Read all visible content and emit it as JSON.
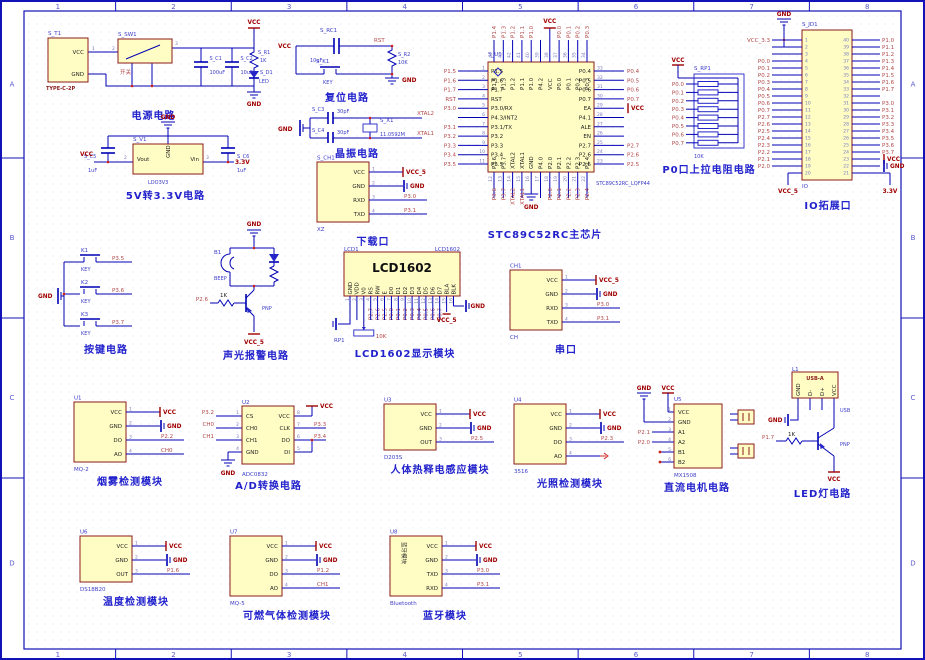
{
  "sheet": {
    "zones_h": [
      "1",
      "2",
      "3",
      "4",
      "5",
      "6",
      "7",
      "8"
    ],
    "zones_v": [
      "A",
      "B",
      "C",
      "D"
    ]
  },
  "colors": {
    "frame": "#1212b8",
    "wire": "#0000b4",
    "component_fill": "#fffdc4",
    "component_border": "#8b1a1a",
    "net_label": "#b34747",
    "power_label": "#a00000",
    "designator": "#3c3cc8",
    "caption": "#2222cc"
  },
  "modules": {
    "power": {
      "designator": "S_T1",
      "footprint": "TYPE-C-2P",
      "pin_vcc": "VCC",
      "pin_gnd": "GND",
      "num1": "1",
      "num2": "2",
      "num3": "3",
      "sw_designator": "S_SW1",
      "sw_label": "开关",
      "c1_designator": "S_C1",
      "c1_value": "100uF",
      "c2_designator": "S_C2",
      "c2_value": "10uF",
      "r1_designator": "S_R1",
      "r1_value": "1K",
      "d1_designator": "S_D1",
      "d1_value": "LED",
      "vcc": "VCC",
      "gnd": "GND",
      "caption": "电源电路"
    },
    "ldo": {
      "designator": "S_V1",
      "part": "LDO3V3",
      "pin_vout": "Vout",
      "pin_gnd": "GND",
      "pin_vin": "Vin",
      "num2": "2",
      "num3": "3",
      "c5_designator": "S_C5",
      "c5_value": "1uF",
      "c6_designator": "S_C6",
      "c6_value": "1uF",
      "vcc": "VCC",
      "out": "3.3V",
      "gnd": "GND",
      "caption": "5V转3.3V电路"
    },
    "reset": {
      "vcc": "VCC",
      "cap_designator": "S_RC1",
      "cap_value": "10uF",
      "key_designator": "S_K1",
      "key_label": "KEY",
      "rst": "RST",
      "r_designator": "S_R2",
      "r_value": "10K",
      "gnd": "GND",
      "caption": "复位电路"
    },
    "crystal": {
      "gnd": "GND",
      "c3_designator": "S_C3",
      "c3_value": "30pF",
      "c4_designator": "S_C4",
      "c4_value": "30pF",
      "x_designator": "S_X1",
      "x_value": "11.0592M",
      "net_top": "XTAL2",
      "net_bottom": "XTAL1",
      "caption": "晶振电路"
    },
    "mcu": {
      "designator": "S_U1",
      "footprint": "STC89C52RC_LQFP44",
      "vcc": "VCC",
      "gnd": "GND",
      "caption": "STC89C52RC主芯片",
      "left": [
        [
          "P1.5",
          "1",
          "P1.5"
        ],
        [
          "P1.6",
          "2",
          "P1.6"
        ],
        [
          "P1.7",
          "3",
          "P1.7"
        ],
        [
          "RST",
          "4",
          "RST"
        ],
        [
          "P3.0/RX",
          "5",
          "P3.0"
        ],
        [
          "P4.3/INT2",
          "6",
          ""
        ],
        [
          "P3.1/TX",
          "7",
          "P3.1"
        ],
        [
          "P3.2",
          "8",
          "P3.2"
        ],
        [
          "P3.3",
          "9",
          "P3.3"
        ],
        [
          "P3.4",
          "10",
          "P3.4"
        ],
        [
          "P3.5",
          "11",
          "P3.5"
        ]
      ],
      "right": [
        [
          "P0.4",
          "33",
          "P0.4"
        ],
        [
          "P0.5",
          "32",
          "P0.5"
        ],
        [
          "P0.6",
          "31",
          "P0.6"
        ],
        [
          "P0.7",
          "30",
          "P0.7"
        ],
        [
          "EA",
          "29",
          "VCC"
        ],
        [
          "P4.1",
          "28",
          ""
        ],
        [
          "ALE",
          "27",
          ""
        ],
        [
          "EN",
          "26",
          ""
        ],
        [
          "P2.7",
          "25",
          "P2.7"
        ],
        [
          "P2.6",
          "24",
          "P2.6"
        ],
        [
          "P2.5",
          "23",
          "P2.5"
        ]
      ],
      "top": [
        [
          "P1.4",
          "44",
          "P1.4"
        ],
        [
          "P1.3",
          "43",
          "P1.3"
        ],
        [
          "P1.2",
          "42",
          "P1.2"
        ],
        [
          "P1.1",
          "41",
          "P1.1"
        ],
        [
          "P1.0",
          "40",
          "P1.0"
        ],
        [
          "P4.2",
          "39",
          ""
        ],
        [
          "VCC",
          "38",
          "VCC"
        ],
        [
          "P0.0",
          "37",
          "P0.0"
        ],
        [
          "P0.1",
          "36",
          "P0.1"
        ],
        [
          "P0.2",
          "35",
          "P0.2"
        ],
        [
          "P0.3",
          "34",
          "P0.3"
        ]
      ],
      "bottom": [
        [
          "P3.6",
          "12",
          "P3.6"
        ],
        [
          "P3.7",
          "13",
          "P3.7"
        ],
        [
          "XTAL2",
          "14",
          "XTAL2"
        ],
        [
          "XTAL1",
          "15",
          "XTAL1"
        ],
        [
          "GND",
          "16",
          "GND"
        ],
        [
          "P4.0",
          "17",
          ""
        ],
        [
          "P2.0",
          "18",
          "P2.0"
        ],
        [
          "P2.1",
          "19",
          "P2.1"
        ],
        [
          "P2.2",
          "20",
          "P2.2"
        ],
        [
          "P2.3",
          "21",
          "P2.3"
        ],
        [
          "P2.4",
          "22",
          "P2.4"
        ]
      ]
    },
    "p0": {
      "designator": "S_RP1",
      "value": "10K",
      "vcc": "VCC",
      "nets": [
        "P0.0",
        "P0.1",
        "P0.2",
        "P0.3",
        "P0.4",
        "P0.5",
        "P0.6",
        "P0.7"
      ],
      "caption": "P0口上拉电阻电路"
    },
    "io": {
      "designator": "S_JD1",
      "part": "IO",
      "gnd": "GND",
      "vcc5": "VCC_5",
      "v33": "3.3V",
      "left_nums": [
        "1",
        "2",
        "3",
        "4",
        "5",
        "6",
        "7",
        "8",
        "9",
        "10",
        "11",
        "12",
        "13",
        "14",
        "15",
        "16",
        "17",
        "18",
        "19",
        "20"
      ],
      "right_nums": [
        "40",
        "39",
        "38",
        "37",
        "36",
        "35",
        "34",
        "33",
        "32",
        "31",
        "30",
        "29",
        "28",
        "27",
        "26",
        "25",
        "24",
        "23",
        "22",
        "21"
      ],
      "left_nets": [
        "VCC_3.3",
        "",
        "",
        "P0.0",
        "P0.1",
        "P0.2",
        "P0.3",
        "P0.4",
        "P0.5",
        "P0.6",
        "P0.7",
        "P2.7",
        "P2.6",
        "P2.5",
        "P2.4",
        "P2.3",
        "P2.2",
        "P2.1",
        "P2.0",
        ""
      ],
      "right_nets": [
        "P1.0",
        "P1.1",
        "P1.2",
        "P1.3",
        "P1.4",
        "P1.5",
        "P1.6",
        "P1.7",
        "",
        "P3.0",
        "P3.1",
        "P3.2",
        "P3.3",
        "P3.4",
        "P3.5",
        "P3.6",
        "P3.7",
        "VCC",
        "GND",
        ""
      ],
      "caption": "IO拓展口"
    },
    "download": {
      "designator": "S_CH1",
      "part": "XZ",
      "caption": "下载口",
      "pins": [
        {
          "name": "VCC",
          "num": "1",
          "t": "vcc",
          "net": "VCC_5"
        },
        {
          "name": "GND",
          "num": "2",
          "t": "gnd",
          "net": "GND"
        },
        {
          "name": "RXD",
          "num": "3",
          "t": "net",
          "net": "P3.0"
        },
        {
          "name": "TXD",
          "num": "4",
          "t": "net",
          "net": "P3.1"
        }
      ]
    },
    "serial": {
      "designator": "CH1",
      "part": "CH",
      "caption": "串口",
      "pins": [
        {
          "name": "VCC",
          "num": "1",
          "t": "vcc",
          "net": "VCC_5"
        },
        {
          "name": "GND",
          "num": "2",
          "t": "gnd",
          "net": "GND"
        },
        {
          "name": "RXD",
          "num": "3",
          "t": "net",
          "net": "P3.0"
        },
        {
          "name": "TXD",
          "num": "4",
          "t": "net",
          "net": "P3.1"
        }
      ]
    },
    "keys": {
      "gnd": "GND",
      "caption": "按键电路",
      "items": [
        {
          "designator": "K1",
          "label": "KEY",
          "net": "P3.5"
        },
        {
          "designator": "K2",
          "label": "KEY",
          "net": "P3.6"
        },
        {
          "designator": "K3",
          "label": "KEY",
          "net": "P3.7"
        }
      ]
    },
    "alarm": {
      "gnd": "GND",
      "buzzer_designator": "B1",
      "buzzer_label": "BEEP",
      "base_resistor": "1K",
      "base_net": "P2.6",
      "transistor": "PNP",
      "vcc": "VCC_5",
      "caption": "声光报警电路"
    },
    "lcd": {
      "designator": "LCD1",
      "part": "LCD1602",
      "title": "LCD1602",
      "pot_designator": "RP1",
      "pot_value": "10K",
      "vcc": "VCC_5",
      "gnd": "GND",
      "caption": "LCD1602显示模块",
      "pin_names": [
        "GND",
        "VDD",
        "V0",
        "RS",
        "RW",
        "E",
        "D0",
        "D1",
        "D2",
        "D3",
        "D4",
        "D5",
        "D6",
        "D7",
        "BLA",
        "BLK"
      ],
      "pin_nums": [
        "1",
        "2",
        "3",
        "4",
        "5",
        "6",
        "7",
        "8",
        "9",
        "10",
        "11",
        "12",
        "13",
        "14",
        "15",
        "16"
      ],
      "pin_nets": [
        "",
        "",
        "",
        "P2.7",
        "P2.6",
        "P2.5",
        "P0.0",
        "P0.1",
        "P0.2",
        "P0.3",
        "P0.4",
        "P0.5",
        "P0.6",
        "P0.7",
        "",
        ""
      ]
    },
    "smoke": {
      "designator": "U1",
      "part": "MQ-2",
      "caption": "烟雾检测模块",
      "pins": [
        {
          "name": "VCC",
          "num": "1",
          "t": "vcc",
          "net": "VCC"
        },
        {
          "name": "GND",
          "num": "2",
          "t": "gnd",
          "net": "GND"
        },
        {
          "name": "DO",
          "num": "3",
          "t": "net",
          "net": "P2.2"
        },
        {
          "name": "AO",
          "num": "4",
          "t": "net",
          "net": "CH0"
        }
      ]
    },
    "adc": {
      "designator": "U2",
      "part": "ADC0832",
      "caption": "A/D转换电路",
      "left": [
        {
          "name": "CS",
          "num": "1",
          "net": "P3.2"
        },
        {
          "name": "CH0",
          "num": "2",
          "net": "CH0"
        },
        {
          "name": "CH1",
          "num": "3",
          "net": "CH1"
        },
        {
          "name": "GND",
          "num": "4",
          "net": "GND"
        }
      ],
      "right": [
        {
          "name": "VCC",
          "num": "8",
          "net": "VCC"
        },
        {
          "name": "CLK",
          "num": "7",
          "net": "P3.3"
        },
        {
          "name": "DO",
          "num": "6",
          "net": "P3.4"
        },
        {
          "name": "DI",
          "num": "5",
          "net": ""
        }
      ]
    },
    "pir": {
      "designator": "U3",
      "part": "D203S",
      "caption": "人体热释电感应模块",
      "pins": [
        {
          "name": "VCC",
          "num": "1",
          "t": "vcc",
          "net": "VCC"
        },
        {
          "name": "GND",
          "num": "2",
          "t": "gnd",
          "net": "GND"
        },
        {
          "name": "OUT",
          "num": "3",
          "t": "net",
          "net": "P2.5"
        }
      ]
    },
    "light": {
      "designator": "U4",
      "part": "3516",
      "caption": "光照检测模块",
      "pins": [
        {
          "name": "VCC",
          "num": "1",
          "t": "vcc",
          "net": "VCC"
        },
        {
          "name": "GND",
          "num": "2",
          "t": "gnd",
          "net": "GND"
        },
        {
          "name": "DO",
          "num": "3",
          "t": "net",
          "net": "P2.3"
        },
        {
          "name": "AO",
          "num": "4",
          "t": "nc",
          "net": ""
        }
      ]
    },
    "motor": {
      "designator": "U5",
      "part": "MX1508",
      "gnd": "GND",
      "vcc": "VCC",
      "caption": "直流电机电路",
      "pin_names": [
        "VCC",
        "GND",
        "A1",
        "A2",
        "B1",
        "B2"
      ],
      "pin_nums": [
        "1",
        "2",
        "3",
        "4",
        "5",
        "6"
      ],
      "a1_net": "P2.1",
      "a2_net": "P2.0"
    },
    "led": {
      "designator": "L1",
      "part_label": "USB-A",
      "pin_names": [
        "GND",
        "D-",
        "D+",
        "VCC"
      ],
      "usb_net": "USB",
      "gnd": "GND",
      "resistor": "1K",
      "base_net": "P1.7",
      "transistor": "PNP",
      "vcc": "VCC",
      "caption": "LED灯电路"
    },
    "temp": {
      "designator": "U6",
      "part": "DS18B20",
      "caption": "温度检测模块",
      "pins": [
        {
          "name": "VCC",
          "num": "1",
          "t": "vcc",
          "net": "VCC"
        },
        {
          "name": "GND",
          "num": "2",
          "t": "gnd",
          "net": "GND"
        },
        {
          "name": "OUT",
          "num": "3",
          "t": "net",
          "net": "P1.6"
        }
      ]
    },
    "gas": {
      "designator": "U7",
      "part": "MQ-5",
      "caption": "可燃气体检测模块",
      "pins": [
        {
          "name": "VCC",
          "num": "1",
          "t": "vcc",
          "net": "VCC"
        },
        {
          "name": "GND",
          "num": "2",
          "t": "gnd",
          "net": "GND"
        },
        {
          "name": "DO",
          "num": "3",
          "t": "net",
          "net": "P1.2"
        },
        {
          "name": "AO",
          "num": "4",
          "t": "net",
          "net": "CH1"
        }
      ]
    },
    "bt": {
      "designator": "U8",
      "part": "Bluetooth",
      "inner_label": "蓝牙模块",
      "caption": "蓝牙模块",
      "pins": [
        {
          "name": "VCC",
          "num": "1",
          "t": "vcc",
          "net": "VCC"
        },
        {
          "name": "GND",
          "num": "2",
          "t": "gnd",
          "net": "GND"
        },
        {
          "name": "TXD",
          "num": "3",
          "t": "net",
          "net": "P3.0"
        },
        {
          "name": "RXD",
          "num": "4",
          "t": "net",
          "net": "P3.1"
        }
      ]
    }
  }
}
